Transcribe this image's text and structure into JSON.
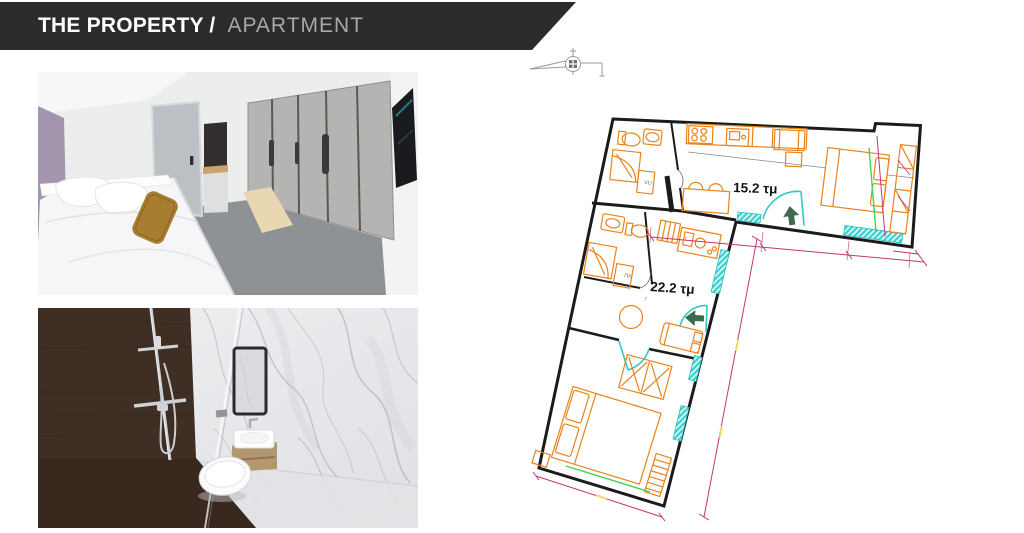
{
  "header": {
    "title_primary": "THE PROPERTY /",
    "title_secondary": "APARTMENT",
    "bar_color": "#2b2b2b"
  },
  "floor_plan": {
    "unit_labels": {
      "studio_area": "15.2 τμ",
      "apartment_area": "22.2 τμ"
    },
    "fixture_labels": {
      "washer_1": "VU",
      "washer_2": "ΠΛ",
      "vent_mark": "↑"
    },
    "legend_colors": {
      "walls": "#1b1b1b",
      "furniture": "#e8831c",
      "windows_doors": "#2fc9c9",
      "dimensions": "#c2366f",
      "entry_arrows": "#3e6b50",
      "accent_green": "#3fd44f",
      "accent_yellow": "#eedd77"
    }
  }
}
